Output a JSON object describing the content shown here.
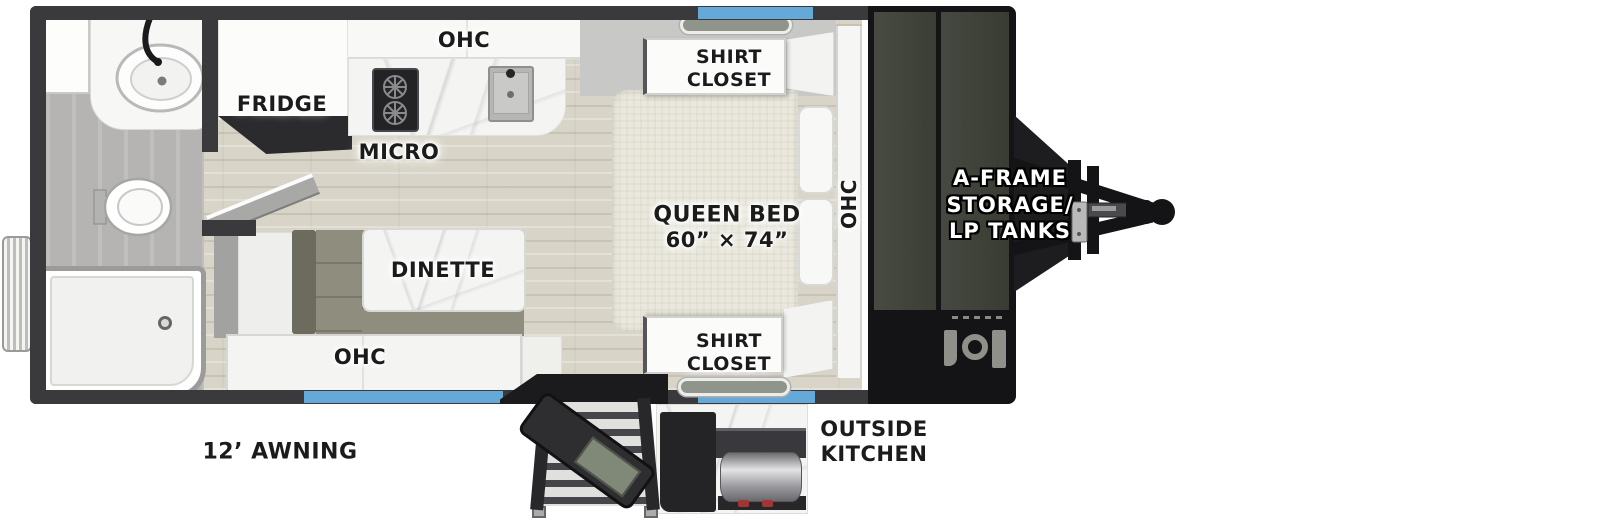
{
  "floorplan": {
    "kitchen": {
      "fridge_label": "FRIDGE",
      "ohc_label": "OHC",
      "micro_label": "MICRO"
    },
    "dinette": {
      "table_label": "DINETTE",
      "ohc_label": "OHC"
    },
    "bedroom": {
      "bed_label_line1": "QUEEN BED",
      "bed_label_line2": "60” × 74”",
      "closet_top_line1": "SHIRT",
      "closet_top_line2": "CLOSET",
      "closet_bottom_line1": "SHIRT",
      "closet_bottom_line2": "CLOSET",
      "ohc_label": "OHC"
    },
    "exterior": {
      "awning_label": "12’ AWNING",
      "outside_kitchen_line1": "OUTSIDE",
      "outside_kitchen_line2": "KITCHEN",
      "front_storage_line1": "A-FRAME",
      "front_storage_line2": "STORAGE/",
      "front_storage_line3": "LP TANKS"
    }
  },
  "colors": {
    "wall": "#3a3a3c",
    "window_blue": "#64a9d8",
    "awning_blue": "#64a9d8",
    "storage_panel": "#42463d",
    "bench_olive": "#8f8e7e",
    "mattress_beige": "#eae8dc",
    "label_text": "#1b1b1b",
    "label_halo": "#ffffff",
    "front_label_text": "#ffffff"
  }
}
